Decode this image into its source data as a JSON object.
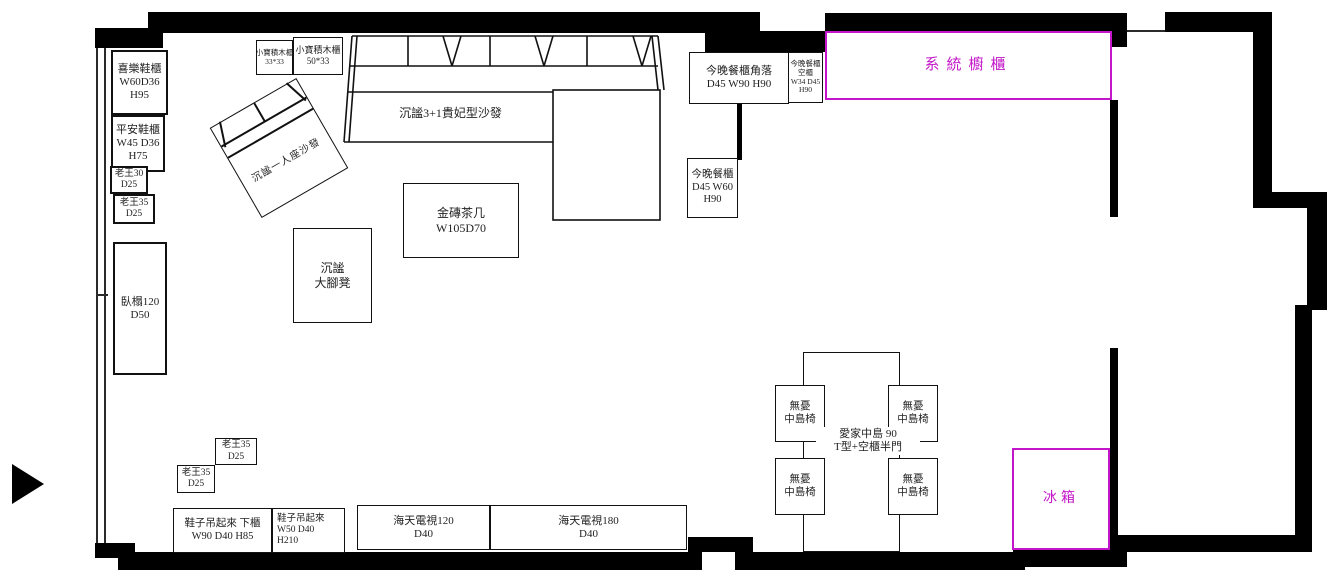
{
  "title": "客廳餐廳家具配置平面圖",
  "colors": {
    "accent": "#c315c9",
    "wall": "#000000",
    "ink": "#1f1f1f"
  },
  "icons": {
    "entry_arrow": "right-filled-triangle"
  },
  "furniture": {
    "xile_shoe_cabinet": [
      "喜樂鞋櫃",
      "W60D36",
      "H95"
    ],
    "pingan_shoe_cabinet": [
      "平安鞋櫃",
      "W45 D36",
      "H75"
    ],
    "laowang_30": [
      "老王30",
      "D25"
    ],
    "laowang_35_left": [
      "老王35",
      "D25"
    ],
    "daybed": [
      "臥榻120",
      "D50"
    ],
    "block_cabinet_small": [
      "小寶積木櫃",
      "33*33"
    ],
    "block_cabinet_large": [
      "小寶積木櫃",
      "50*33"
    ],
    "single_sofa": [
      "沉謐一人座沙發"
    ],
    "sectional_sofa": [
      "沉謐3+1貴妃型沙發"
    ],
    "coffee_table": [
      "金磚茶几",
      "W105D70"
    ],
    "ottoman": [
      "沉謐",
      "大腳凳"
    ],
    "dining_cabinet_corner": [
      "今晚餐櫃角落",
      "D45 W90 H90"
    ],
    "dining_cabinet_empty": [
      "今晚餐櫃",
      "空櫃",
      "W34 D45",
      "H90"
    ],
    "dining_cabinet": [
      "今晚餐櫃",
      "D45 W60",
      "H90"
    ],
    "system_cabinet": [
      "系統櫥櫃"
    ],
    "island": [
      "愛家中島  90",
      "T型+空櫃半門"
    ],
    "island_chair": [
      "無憂",
      "中島椅"
    ],
    "laowang_35_upper": [
      "老王35",
      "D25"
    ],
    "laowang_35_lower": [
      "老王35",
      "D25"
    ],
    "shoe_hang_lower_cabinet": [
      "鞋子吊起來 下櫃",
      "W90 D40 H85"
    ],
    "shoe_hang_tall": [
      "鞋子吊起來",
      "W50 D40",
      "H210"
    ],
    "tv_cabinet_120": [
      "海天電視120",
      "D40"
    ],
    "tv_cabinet_180": [
      "海天電視180",
      "D40"
    ],
    "fridge": [
      "冰箱"
    ]
  }
}
